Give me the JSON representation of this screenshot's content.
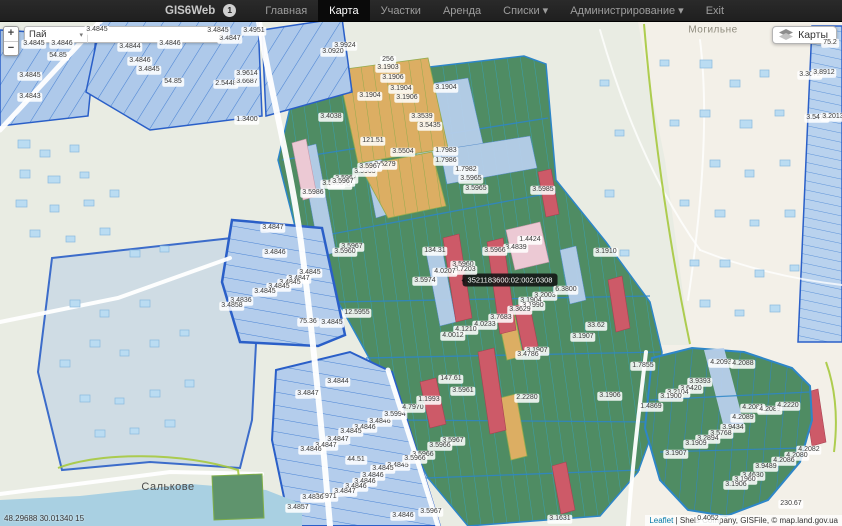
{
  "navbar": {
    "brand": "GIS6Web",
    "badge": "1",
    "items": [
      {
        "key": "home",
        "label": "Главная",
        "active": false,
        "caret": false
      },
      {
        "key": "map",
        "label": "Карта",
        "active": true,
        "caret": false
      },
      {
        "key": "parcels",
        "label": "Участки",
        "active": false,
        "caret": false
      },
      {
        "key": "lease",
        "label": "Аренда",
        "active": false,
        "caret": false
      },
      {
        "key": "lists",
        "label": "Списки",
        "active": false,
        "caret": true
      },
      {
        "key": "admin",
        "label": "Администрирование",
        "active": false,
        "caret": true
      },
      {
        "key": "exit",
        "label": "Exit",
        "active": false,
        "caret": false
      }
    ]
  },
  "controls": {
    "zoom_in": "+",
    "zoom_out": "−",
    "search_select": "Пай",
    "search_value": "",
    "layers_label": "Карты"
  },
  "map": {
    "tooltip": "3521183600:02:002:0308",
    "coords": "48.29688 30.01340 15",
    "attribution_link": "Leaflet",
    "attribution_rest": " | Shels Company, GISFile, © map.land.gov.ua",
    "places": [
      {
        "name": "Могильне",
        "x": 713,
        "y": 30,
        "big": false
      },
      {
        "name": "Салькове",
        "x": 168,
        "y": 487,
        "big": true
      }
    ],
    "parcel_labels": [
      {
        "t": "3.4845",
        "x": 34,
        "y": 44
      },
      {
        "t": "3.4846",
        "x": 62,
        "y": 44
      },
      {
        "t": "54.85",
        "x": 58,
        "y": 56
      },
      {
        "t": "3.4845",
        "x": 30,
        "y": 76
      },
      {
        "t": "3.4843",
        "x": 30,
        "y": 97
      },
      {
        "t": "3.4845",
        "x": 97,
        "y": 30
      },
      {
        "t": "3.4844",
        "x": 130,
        "y": 47
      },
      {
        "t": "3.4846",
        "x": 170,
        "y": 44
      },
      {
        "t": "3.4846",
        "x": 140,
        "y": 61
      },
      {
        "t": "3.4845",
        "x": 149,
        "y": 70
      },
      {
        "t": "54.85",
        "x": 173,
        "y": 82
      },
      {
        "t": "2.5448",
        "x": 226,
        "y": 84
      },
      {
        "t": "3.6687",
        "x": 247,
        "y": 82
      },
      {
        "t": "3.4847",
        "x": 230,
        "y": 39
      },
      {
        "t": "3.4845",
        "x": 218,
        "y": 31
      },
      {
        "t": "3.4951",
        "x": 254,
        "y": 31
      },
      {
        "t": "3.9614",
        "x": 247,
        "y": 74
      },
      {
        "t": "1.3400",
        "x": 247,
        "y": 120
      },
      {
        "t": "3.9924",
        "x": 345,
        "y": 46
      },
      {
        "t": "3.0920",
        "x": 333,
        "y": 52
      },
      {
        "t": "256",
        "x": 388,
        "y": 60
      },
      {
        "t": "3.1903",
        "x": 388,
        "y": 68
      },
      {
        "t": "3.1906",
        "x": 393,
        "y": 78
      },
      {
        "t": "3.1904",
        "x": 401,
        "y": 89
      },
      {
        "t": "3.1904",
        "x": 370,
        "y": 96
      },
      {
        "t": "3.1906",
        "x": 407,
        "y": 98
      },
      {
        "t": "3.1904",
        "x": 446,
        "y": 88
      },
      {
        "t": "3.3539",
        "x": 422,
        "y": 117
      },
      {
        "t": "3.5435",
        "x": 430,
        "y": 126
      },
      {
        "t": "121.51",
        "x": 373,
        "y": 141
      },
      {
        "t": "3.5504",
        "x": 403,
        "y": 152
      },
      {
        "t": "3.5279",
        "x": 385,
        "y": 165
      },
      {
        "t": "3.5967",
        "x": 346,
        "y": 179
      },
      {
        "t": "3.5960",
        "x": 340,
        "y": 185
      },
      {
        "t": "1.7983",
        "x": 446,
        "y": 151
      },
      {
        "t": "1.7986",
        "x": 446,
        "y": 161
      },
      {
        "t": "1.7982",
        "x": 466,
        "y": 170
      },
      {
        "t": "3.5965",
        "x": 471,
        "y": 179
      },
      {
        "t": "3.5965",
        "x": 476,
        "y": 189
      },
      {
        "t": "3.5985",
        "x": 543,
        "y": 190
      },
      {
        "t": "3.5986",
        "x": 313,
        "y": 193
      },
      {
        "t": "3.5900",
        "x": 333,
        "y": 184
      },
      {
        "t": "3.5967",
        "x": 343,
        "y": 182
      },
      {
        "t": "3.5965",
        "x": 365,
        "y": 172
      },
      {
        "t": "3.5967",
        "x": 370,
        "y": 167
      },
      {
        "t": "3.4038",
        "x": 331,
        "y": 117
      },
      {
        "t": "3.4847",
        "x": 273,
        "y": 228
      },
      {
        "t": "3.4846",
        "x": 275,
        "y": 253
      },
      {
        "t": "3.4845",
        "x": 310,
        "y": 273
      },
      {
        "t": "3.4847",
        "x": 299,
        "y": 279
      },
      {
        "t": "3.4845",
        "x": 290,
        "y": 283
      },
      {
        "t": "3.4845",
        "x": 279,
        "y": 287
      },
      {
        "t": "3.4845",
        "x": 265,
        "y": 292
      },
      {
        "t": "3.4836",
        "x": 241,
        "y": 301
      },
      {
        "t": "3.4858",
        "x": 232,
        "y": 306
      },
      {
        "t": "75.36",
        "x": 308,
        "y": 322
      },
      {
        "t": "3.4845",
        "x": 332,
        "y": 323
      },
      {
        "t": "12.5955",
        "x": 357,
        "y": 313
      },
      {
        "t": "3.5967",
        "x": 352,
        "y": 247
      },
      {
        "t": "3.5960",
        "x": 345,
        "y": 252
      },
      {
        "t": "134.31",
        "x": 435,
        "y": 251
      },
      {
        "t": "1.4424",
        "x": 530,
        "y": 240
      },
      {
        "t": "3.4839",
        "x": 516,
        "y": 248
      },
      {
        "t": "3.5966",
        "x": 495,
        "y": 251
      },
      {
        "t": "3.5960",
        "x": 463,
        "y": 265
      },
      {
        "t": "3.7203",
        "x": 465,
        "y": 270
      },
      {
        "t": "4.0207",
        "x": 445,
        "y": 272
      },
      {
        "t": "3.5974",
        "x": 425,
        "y": 281
      },
      {
        "t": "3.2003",
        "x": 545,
        "y": 296
      },
      {
        "t": "6.3800",
        "x": 566,
        "y": 290
      },
      {
        "t": "3.1904",
        "x": 531,
        "y": 301
      },
      {
        "t": "3.1990",
        "x": 533,
        "y": 306
      },
      {
        "t": "3.3629",
        "x": 520,
        "y": 310
      },
      {
        "t": "3.7683",
        "x": 501,
        "y": 318
      },
      {
        "t": "4.0233",
        "x": 485,
        "y": 325
      },
      {
        "t": "4.1210",
        "x": 466,
        "y": 330
      },
      {
        "t": "4.0012",
        "x": 453,
        "y": 336
      },
      {
        "t": "3.1910",
        "x": 606,
        "y": 252
      },
      {
        "t": "33.62",
        "x": 596,
        "y": 326
      },
      {
        "t": "3.1907",
        "x": 583,
        "y": 337
      },
      {
        "t": "1.7855",
        "x": 643,
        "y": 366
      },
      {
        "t": "147.61",
        "x": 451,
        "y": 379
      },
      {
        "t": "3.1907",
        "x": 537,
        "y": 351
      },
      {
        "t": "3.4786",
        "x": 528,
        "y": 355
      },
      {
        "t": "2.2280",
        "x": 527,
        "y": 398
      },
      {
        "t": "3.1906",
        "x": 610,
        "y": 396
      },
      {
        "t": "3.4844",
        "x": 338,
        "y": 382
      },
      {
        "t": "3.4847",
        "x": 308,
        "y": 394
      },
      {
        "t": "3.4846",
        "x": 380,
        "y": 422
      },
      {
        "t": "3.4846",
        "x": 365,
        "y": 428
      },
      {
        "t": "3.4845",
        "x": 351,
        "y": 432
      },
      {
        "t": "3.4847",
        "x": 338,
        "y": 440
      },
      {
        "t": "3.4847",
        "x": 326,
        "y": 446
      },
      {
        "t": "3.4846",
        "x": 311,
        "y": 450
      },
      {
        "t": "44.51",
        "x": 356,
        "y": 460
      },
      {
        "t": "3.4845",
        "x": 398,
        "y": 466
      },
      {
        "t": "3.4845",
        "x": 383,
        "y": 469
      },
      {
        "t": "3.4846",
        "x": 373,
        "y": 476
      },
      {
        "t": "3.4846",
        "x": 365,
        "y": 482
      },
      {
        "t": "3.4846",
        "x": 356,
        "y": 487
      },
      {
        "t": "3.4847",
        "x": 345,
        "y": 492
      },
      {
        "t": "2.6971",
        "x": 326,
        "y": 497
      },
      {
        "t": "3.4836",
        "x": 313,
        "y": 498
      },
      {
        "t": "3.4857",
        "x": 298,
        "y": 508
      },
      {
        "t": "3.4846",
        "x": 403,
        "y": 516
      },
      {
        "t": "3.5994",
        "x": 395,
        "y": 415
      },
      {
        "t": "4.7970",
        "x": 413,
        "y": 408
      },
      {
        "t": "1.1993",
        "x": 429,
        "y": 400
      },
      {
        "t": "3.5961",
        "x": 463,
        "y": 391
      },
      {
        "t": "3.5966",
        "x": 423,
        "y": 455
      },
      {
        "t": "3.5966",
        "x": 415,
        "y": 459
      },
      {
        "t": "3.5967",
        "x": 453,
        "y": 441
      },
      {
        "t": "3.5966",
        "x": 440,
        "y": 446
      },
      {
        "t": "3.5967",
        "x": 431,
        "y": 512
      },
      {
        "t": "3.1631",
        "x": 560,
        "y": 519
      },
      {
        "t": "4.2093",
        "x": 721,
        "y": 363
      },
      {
        "t": "4.2088",
        "x": 743,
        "y": 364
      },
      {
        "t": "3.9393",
        "x": 700,
        "y": 382
      },
      {
        "t": "3.6420",
        "x": 691,
        "y": 389
      },
      {
        "t": "3.2104",
        "x": 678,
        "y": 393
      },
      {
        "t": "3.1900",
        "x": 671,
        "y": 397
      },
      {
        "t": "1.4869",
        "x": 651,
        "y": 407
      },
      {
        "t": "4.2081",
        "x": 753,
        "y": 408
      },
      {
        "t": "4.2089",
        "x": 770,
        "y": 410
      },
      {
        "t": "4.2220",
        "x": 788,
        "y": 406
      },
      {
        "t": "4.2089",
        "x": 743,
        "y": 418
      },
      {
        "t": "3.9434",
        "x": 733,
        "y": 428
      },
      {
        "t": "3.5768",
        "x": 721,
        "y": 434
      },
      {
        "t": "3.2894",
        "x": 708,
        "y": 439
      },
      {
        "t": "3.1909",
        "x": 696,
        "y": 444
      },
      {
        "t": "3.1907",
        "x": 676,
        "y": 454
      },
      {
        "t": "4.2082",
        "x": 809,
        "y": 450
      },
      {
        "t": "4.2080",
        "x": 797,
        "y": 456
      },
      {
        "t": "4.2086",
        "x": 784,
        "y": 461
      },
      {
        "t": "3.9489",
        "x": 766,
        "y": 467
      },
      {
        "t": "3.4630",
        "x": 753,
        "y": 476
      },
      {
        "t": "3.1960",
        "x": 745,
        "y": 480
      },
      {
        "t": "3.1906",
        "x": 736,
        "y": 485
      },
      {
        "t": "75.2",
        "x": 830,
        "y": 43
      },
      {
        "t": "3.3072",
        "x": 810,
        "y": 75
      },
      {
        "t": "3.8912",
        "x": 824,
        "y": 73
      },
      {
        "t": "3.5475",
        "x": 817,
        "y": 118
      },
      {
        "t": "3.2013",
        "x": 833,
        "y": 117
      },
      {
        "t": "230.67",
        "x": 791,
        "y": 504
      },
      {
        "t": "0.4052",
        "x": 708,
        "y": 519
      }
    ]
  },
  "colors": {
    "navbar-bg": "#1f1f1f",
    "navbar-active-bg": "#0a0a0a",
    "navbar-text": "#9d9d9d",
    "navbar-active-text": "#ffffff",
    "brand-text": "#c8c8c8",
    "map-base": "#e9ece3",
    "village-beige": "#f3f0e8",
    "parcel-blue": "#aec9ea",
    "parcel-blue-line": "#4a83d4",
    "blue-border": "#2a5fc8",
    "parcel-green": "#4f8c63",
    "green-line": "#3a9fae",
    "green-border": "#2d86c8",
    "orange": "#dcae63",
    "orange-line": "#93ab4d",
    "red": "#cd5a68",
    "pink": "#ecc9d4",
    "lightblue-strip": "#b7cfeb",
    "road": "#ffffff",
    "water": "#a9d0e2",
    "boundary-green": "#a6c93e",
    "building": "#badcf2",
    "building-line": "#8abade"
  }
}
